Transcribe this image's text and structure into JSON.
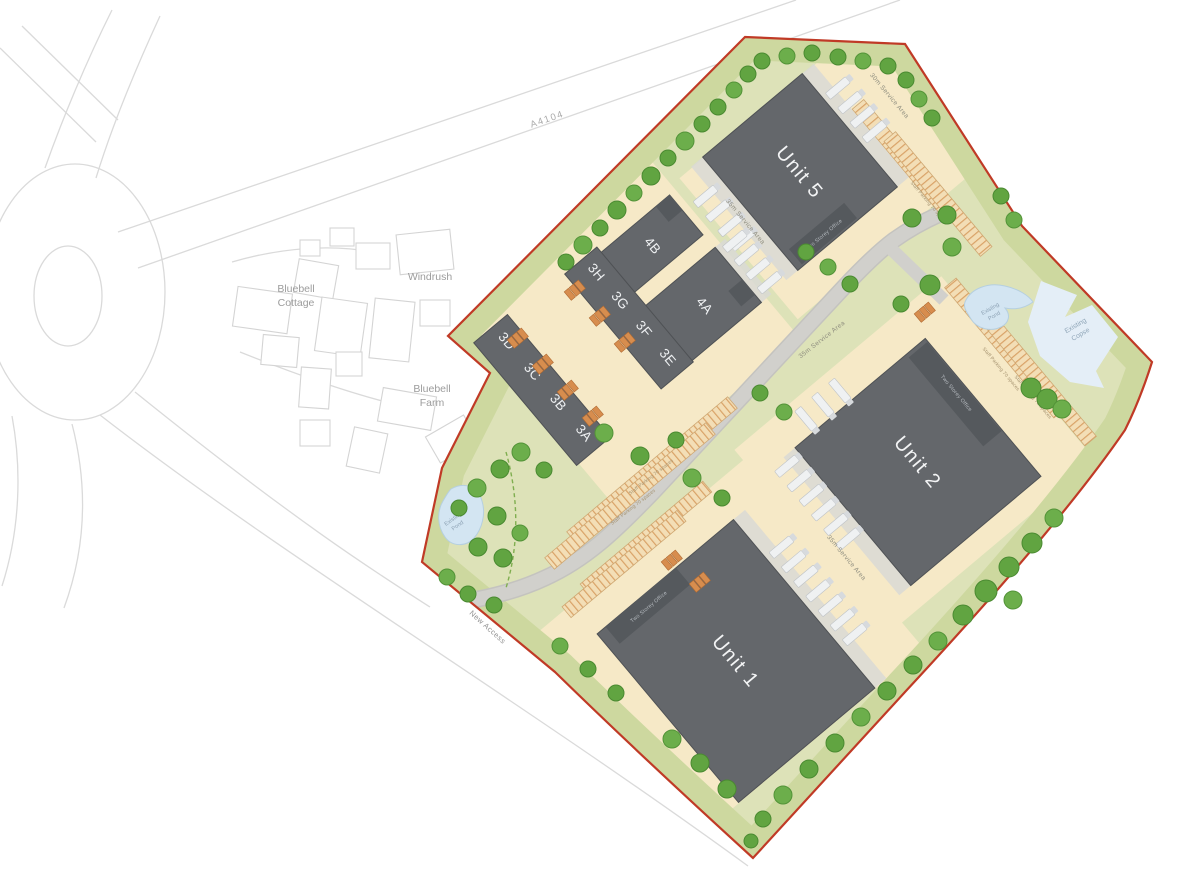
{
  "context": {
    "a4104": "A4104",
    "windrush": "Windrush",
    "bluebell_cottage": [
      "Bluebell",
      "Cottage"
    ],
    "bluebell_farm": [
      "Bluebell",
      "Farm"
    ],
    "new_access": "New Access"
  },
  "units": {
    "unit1": "Unit 1",
    "unit2": "Unit 2",
    "unit5": "Unit 5",
    "u4a": "4A",
    "u4b": "4B",
    "u3a": "3A",
    "u3b": "3B",
    "u3c": "3C",
    "u3d": "3D",
    "u3e": "3E",
    "u3f": "3F",
    "u3g": "3G",
    "u3h": "3H"
  },
  "annotations": {
    "service_30": "30m Service Area",
    "service_35": "35m Service Area",
    "staff_parking": "Staff Parking 70 spaces",
    "office": "Two Storey Office",
    "existing_pond": [
      "Existing",
      "Pond"
    ],
    "existing_copse": [
      "Existing",
      "Copse"
    ]
  },
  "colors": {
    "site_boundary": "#c03a26",
    "building": "#64676b",
    "grass": "#dde2b8",
    "grass_margin": "#cdd89f",
    "hardstanding": "#f6e9c7",
    "road": "#d1d0cc",
    "parking_stripe": "#d9a267",
    "tree": "#61a441",
    "water": "#d3e5f2"
  },
  "map": {
    "trees": [
      [
        566,
        262,
        8
      ],
      [
        583,
        245,
        9
      ],
      [
        600,
        228,
        8
      ],
      [
        617,
        210,
        9
      ],
      [
        634,
        193,
        8
      ],
      [
        651,
        176,
        9
      ],
      [
        668,
        158,
        8
      ],
      [
        685,
        141,
        9
      ],
      [
        702,
        124,
        8
      ],
      [
        718,
        107,
        8
      ],
      [
        734,
        90,
        8
      ],
      [
        748,
        74,
        8
      ],
      [
        762,
        61,
        8
      ],
      [
        787,
        56,
        8
      ],
      [
        812,
        53,
        8
      ],
      [
        838,
        57,
        8
      ],
      [
        863,
        61,
        8
      ],
      [
        888,
        66,
        8
      ],
      [
        906,
        80,
        8
      ],
      [
        919,
        99,
        8
      ],
      [
        932,
        118,
        8
      ],
      [
        1001,
        196,
        8
      ],
      [
        1014,
        220,
        8
      ],
      [
        1031,
        388,
        10
      ],
      [
        1047,
        399,
        10
      ],
      [
        1062,
        409,
        9
      ],
      [
        912,
        218,
        9
      ],
      [
        947,
        215,
        9
      ],
      [
        952,
        247,
        9
      ],
      [
        930,
        285,
        10
      ],
      [
        901,
        304,
        8
      ],
      [
        1054,
        518,
        9
      ],
      [
        1032,
        543,
        10
      ],
      [
        1009,
        567,
        10
      ],
      [
        1013,
        600,
        9
      ],
      [
        986,
        591,
        11
      ],
      [
        963,
        615,
        10
      ],
      [
        938,
        641,
        9
      ],
      [
        913,
        665,
        9
      ],
      [
        887,
        691,
        9
      ],
      [
        861,
        717,
        9
      ],
      [
        835,
        743,
        9
      ],
      [
        809,
        769,
        9
      ],
      [
        783,
        795,
        9
      ],
      [
        763,
        819,
        8
      ],
      [
        751,
        841,
        7
      ],
      [
        521,
        452,
        9
      ],
      [
        544,
        470,
        8
      ],
      [
        500,
        469,
        9
      ],
      [
        477,
        488,
        9
      ],
      [
        459,
        508,
        8
      ],
      [
        497,
        516,
        9
      ],
      [
        520,
        533,
        8
      ],
      [
        478,
        547,
        9
      ],
      [
        503,
        558,
        9
      ],
      [
        447,
        577,
        8
      ],
      [
        468,
        594,
        8
      ],
      [
        494,
        605,
        8
      ],
      [
        560,
        646,
        8
      ],
      [
        588,
        669,
        8
      ],
      [
        616,
        693,
        8
      ],
      [
        672,
        739,
        9
      ],
      [
        700,
        763,
        9
      ],
      [
        727,
        789,
        9
      ],
      [
        604,
        433,
        9
      ],
      [
        640,
        456,
        9
      ],
      [
        676,
        440,
        8
      ],
      [
        692,
        478,
        9
      ],
      [
        722,
        498,
        8
      ],
      [
        806,
        252,
        8
      ],
      [
        828,
        267,
        8
      ],
      [
        850,
        284,
        8
      ],
      [
        760,
        393,
        8
      ],
      [
        784,
        412,
        8
      ]
    ],
    "car_clusters": [
      [
        518,
        338
      ],
      [
        543,
        364
      ],
      [
        568,
        390
      ],
      [
        593,
        416
      ],
      [
        575,
        290
      ],
      [
        600,
        316
      ],
      [
        625,
        342
      ],
      [
        925,
        312
      ],
      [
        672,
        560
      ],
      [
        700,
        582
      ]
    ]
  }
}
